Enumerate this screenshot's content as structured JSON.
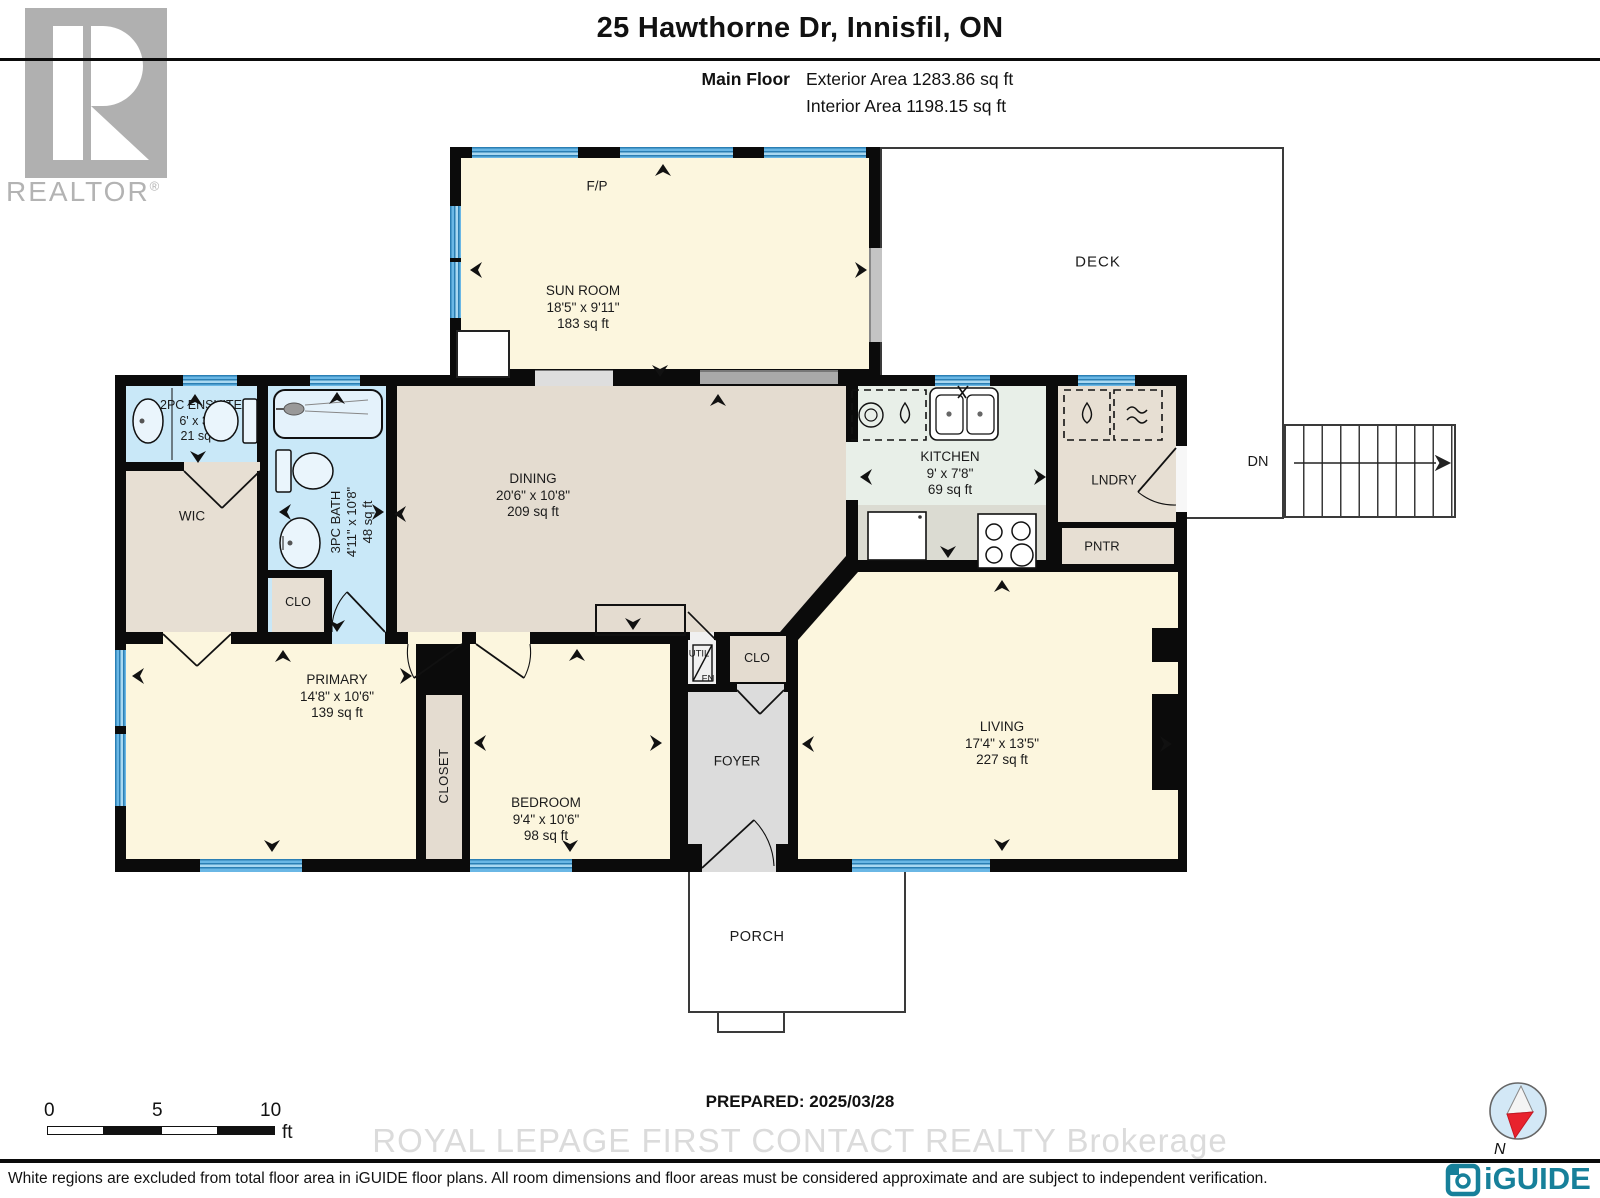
{
  "header": {
    "title": "25 Hawthorne Dr, Innisfil, ON",
    "floor_label": "Main Floor",
    "exterior_area": "Exterior Area 1283.86 sq ft",
    "interior_area": "Interior Area 1198.15 sq ft"
  },
  "branding": {
    "realtor_logo_text": "REALTOR",
    "realtor_logo_reg": "®",
    "watermark": "ROYAL LEPAGE FIRST CONTACT REALTY  Brokerage",
    "iguide_logo_text": "iGUIDE",
    "compass_north_label": "N"
  },
  "plan": {
    "deck_label": "DECK",
    "dn_label": "DN",
    "fp_label": "F/P",
    "rooms": {
      "sun_room": {
        "name": "SUN ROOM",
        "dims": "18'5\" x 9'11\"",
        "area": "183 sq ft"
      },
      "ensuite": {
        "name": "2PC ENSUITE",
        "dims": "6' x 3'5\"",
        "area": "21 sq ft"
      },
      "wic": {
        "name": "WIC"
      },
      "bath": {
        "name": "3PC BATH",
        "dims": "4'11\" x 10'8\"",
        "area": "48 sq ft"
      },
      "bath_closet": {
        "name": "CLO"
      },
      "dining": {
        "name": "DINING",
        "dims": "20'6\" x 10'8\"",
        "area": "209 sq ft"
      },
      "kitchen": {
        "name": "KITCHEN",
        "dims": "9' x 7'8\"",
        "area": "69 sq ft"
      },
      "laundry": {
        "name": "LNDRY"
      },
      "pantry": {
        "name": "PNTR"
      },
      "primary": {
        "name": "PRIMARY",
        "dims": "14'8\" x 10'6\"",
        "area": "139 sq ft"
      },
      "closet": {
        "name": "CLOSET"
      },
      "bedroom": {
        "name": "BEDROOM",
        "dims": "9'4\" x 10'6\"",
        "area": "98 sq ft"
      },
      "utility": {
        "name": "UTIL",
        "sub": "FN"
      },
      "foyer_closet": {
        "name": "CLO"
      },
      "foyer": {
        "name": "FOYER"
      },
      "living": {
        "name": "LIVING",
        "dims": "17'4\" x 13'5\"",
        "area": "227 sq ft"
      },
      "porch": {
        "name": "PORCH"
      }
    }
  },
  "footer": {
    "scale_bar": {
      "tick_0": "0",
      "tick_5": "5",
      "tick_10": "10",
      "unit": "ft"
    },
    "prepared": "PREPARED: 2025/03/28",
    "disclaimer": "White regions are excluded from total floor area in iGUIDE floor plans. All room dimensions and floor areas must be considered approximate and are subject to independent verification."
  },
  "colors": {
    "wall": "#0b0b0b",
    "room_yellow": "#fcf6de",
    "room_beige": "#e7dfd3",
    "room_blue": "#c9e8f8",
    "room_kitchen": "#e8efe8",
    "room_gray": "#dcdcdc",
    "window_blue": "#3d97ce",
    "iguide_teal": "#17809a",
    "compass_red": "#e8222d",
    "logo_gray": "#b0b0b0"
  }
}
